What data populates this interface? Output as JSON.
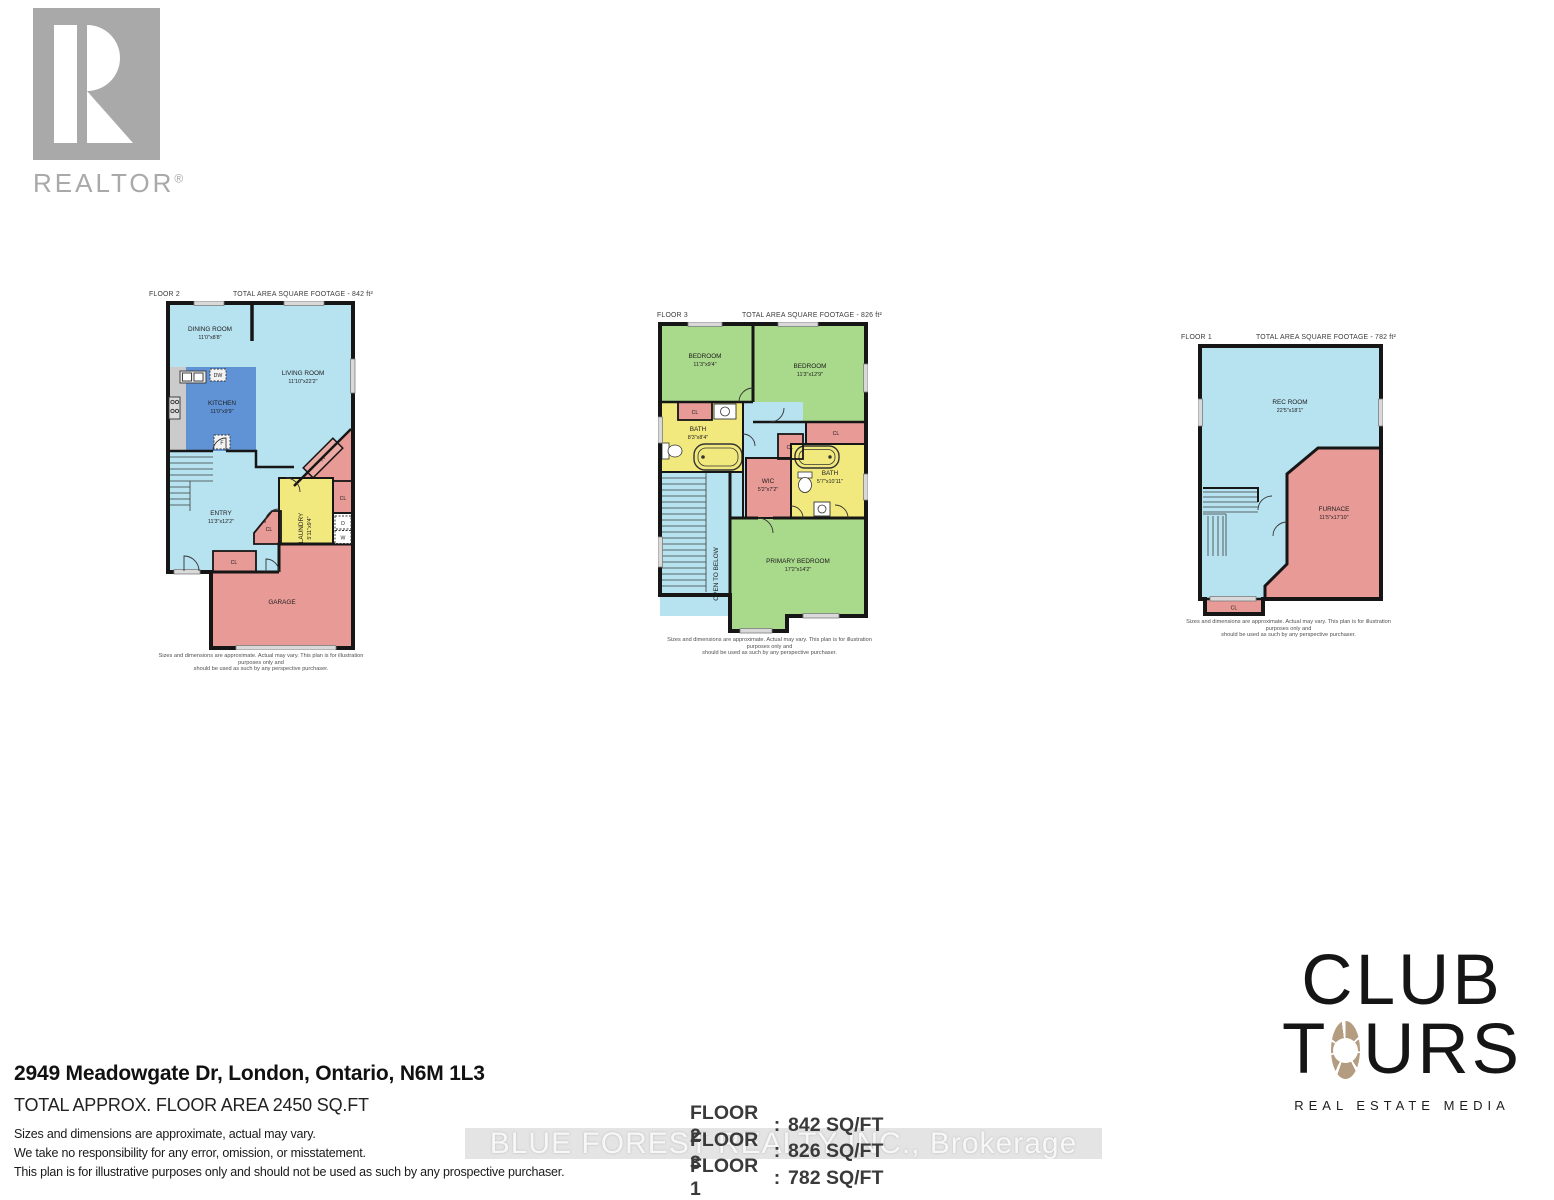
{
  "branding": {
    "realtor": {
      "label": "REALTOR",
      "reg": "®"
    },
    "watermark": "BLUE FOREST REALTY INC., Brokerage",
    "clubtours": {
      "word1": "CLUB",
      "word2_t": "T",
      "word2_urs": "URS",
      "tagline": "REAL ESTATE MEDIA"
    }
  },
  "plans": [
    {
      "floor": "FLOOR 2",
      "total": "TOTAL AREA SQUARE FOOTAGE - 842 ft²",
      "rooms": {
        "dining": {
          "n": "DINING ROOM",
          "d": "11'0\"x8'8\""
        },
        "living": {
          "n": "LIVING ROOM",
          "d": "11'10\"x22'2\""
        },
        "kitchen": {
          "n": "KITCHEN",
          "d": "11'0\"x9'9\""
        },
        "entry": {
          "n": "ENTRY",
          "d": "11'3\"x12'2\""
        },
        "laundry": {
          "n": "LAUNDRY",
          "d": "5'11\"x9'4\""
        },
        "garage": {
          "n": "GARAGE"
        }
      },
      "tags": {
        "cl": "CL",
        "fp": "FP",
        "f": "F",
        "dw": "DW",
        "d": "D",
        "w": "W"
      },
      "disc1": "Sizes and dimensions are approximate. Actual may vary. This plan is for illustration purposes only and",
      "disc2": "should be used as such by any perspective purchaser."
    },
    {
      "floor": "FLOOR 3",
      "total": "TOTAL AREA SQUARE FOOTAGE - 826 ft²",
      "rooms": {
        "bed1": {
          "n": "BEDROOM",
          "d": "11'3\"x9'4\""
        },
        "bed2": {
          "n": "BEDROOM",
          "d": "11'3\"x12'9\""
        },
        "bath1": {
          "n": "BATH",
          "d": "8'3\"x8'4\""
        },
        "bath2": {
          "n": "BATH",
          "d": "5'7\"x10'11\""
        },
        "wic": {
          "n": "WIC",
          "d": "5'2\"x7'2\""
        },
        "primary": {
          "n": "PRIMARY BEDROOM",
          "d": "17'2\"x14'2\""
        },
        "open": {
          "n": "OPEN TO BELOW"
        }
      },
      "tags": {
        "cl": "CL"
      },
      "disc1": "Sizes and dimensions are approximate. Actual may vary. This plan is for illustration purposes only and",
      "disc2": "should be used as such by any perspective purchaser."
    },
    {
      "floor": "FLOOR 1",
      "total": "TOTAL AREA SQUARE FOOTAGE - 782 ft²",
      "rooms": {
        "rec": {
          "n": "REC ROOM",
          "d": "22'5\"x18'1\""
        },
        "furnace": {
          "n": "FURNACE",
          "d": "11'5\"x17'10\""
        }
      },
      "tags": {
        "cl": "CL"
      },
      "disc1": "Sizes and dimensions are approximate. Actual may vary. This plan is for illustration purposes only and",
      "disc2": "should be used as such by any perspective purchaser."
    }
  ],
  "footer": {
    "address": "2949 Meadowgate Dr, London, Ontario, N6M 1L3",
    "total_area": "TOTAL APPROX. FLOOR AREA 2450 SQ.FT",
    "notes": [
      "Sizes and dimensions are approximate, actual may vary.",
      "We take no responsibility for any error, omission, or misstatement.",
      "This plan is for illustrative purposes only and should not be used as such by any prospective purchaser."
    ],
    "sep": ":",
    "floor_areas": [
      {
        "label": "FLOOR 2",
        "value": "842 SQ/FT"
      },
      {
        "label": "FLOOR 3",
        "value": "826 SQ/FT"
      },
      {
        "label": "FLOOR 1",
        "value": "782 SQ/FT"
      }
    ]
  },
  "colors": {
    "room_blue": "#b7e2f0",
    "room_green": "#a9d98b",
    "room_yellow": "#f1e97e",
    "room_pink": "#e89a96",
    "kitchen_blue": "#6093d6",
    "counter_gray": "#cbcbcb",
    "wall": "#161616",
    "aperture_tan": "#b49c80",
    "logo_gray": "#a9a9a9"
  }
}
